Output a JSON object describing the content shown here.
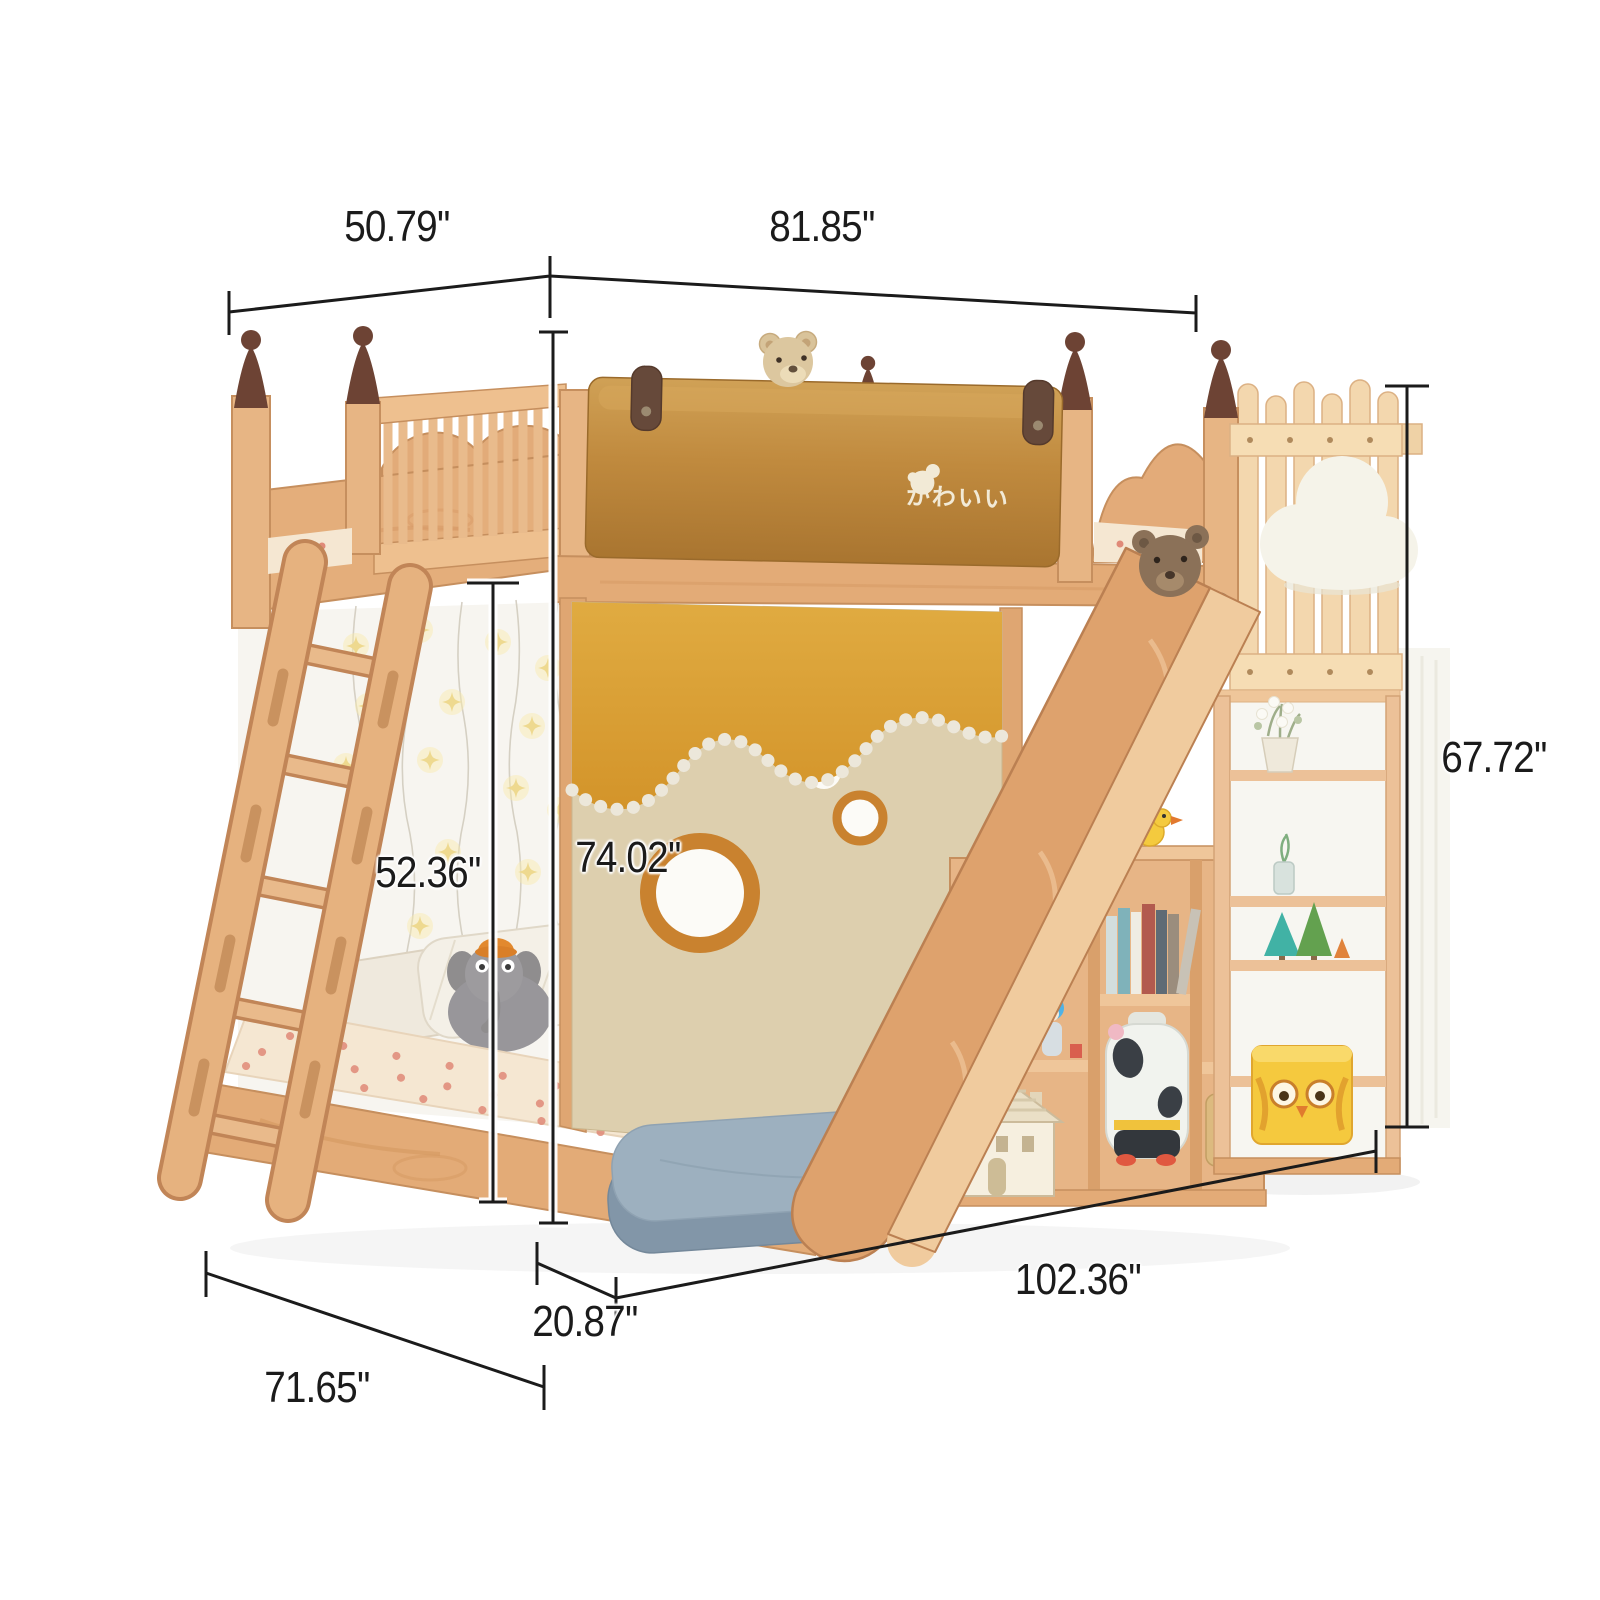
{
  "image": {
    "description": "Product dimension diagram of a kids wooden bunk bed with slide, ladder, star lights, picket-fence bookcase, cloud lamp and play curtain",
    "background": "#ffffff"
  },
  "branding": {
    "logo_text": "かわいい",
    "logo_icon": "bear-head-icon",
    "logo_color": "#f2ead6"
  },
  "dimensions": {
    "unit": "inches",
    "labels": {
      "upper_bed_depth": "50.79''",
      "upper_bed_width": "81.85''",
      "fence_post_height": "67.72''",
      "bunk_opening_height": "52.36''",
      "overall_height": "74.02''",
      "overall_length": "102.36''",
      "step_cushion_depth": "20.87''",
      "lower_bed_depth": "71.65''"
    }
  },
  "palette": {
    "wood_light": "#f3d7ae",
    "wood_mid": "#e3ab77",
    "wood_deep": "#c68f5e",
    "finial_brown": "#6d4334",
    "leather_caramel": "#c08a3e",
    "leather_amber": "#d89b2e",
    "linen_beige": "#ddcfae",
    "interior_white": "#f7f5f0",
    "cushion_blue": "#9db0bf",
    "cloud_white": "#f5f3e9",
    "dimension_ink": "#1b1b1b"
  }
}
